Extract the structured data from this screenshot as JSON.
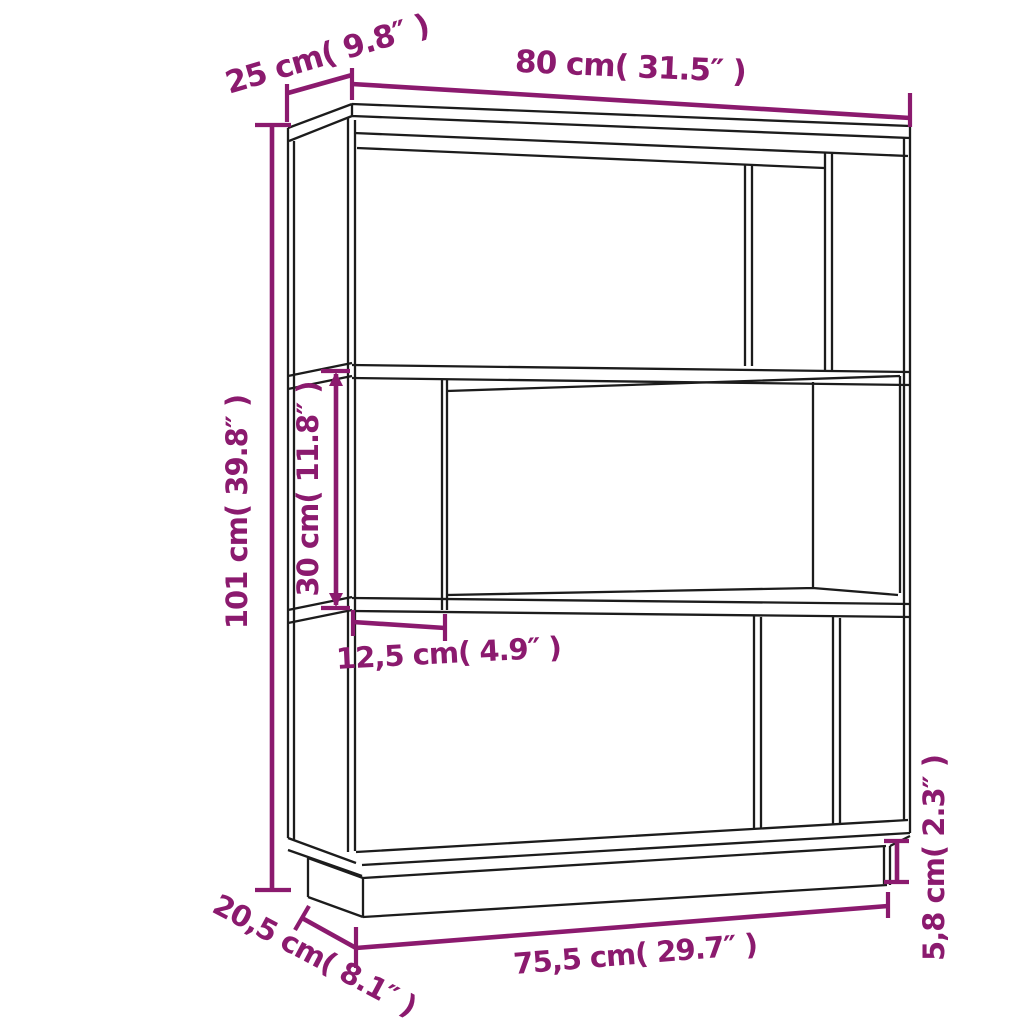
{
  "page": {
    "background": "#ffffff"
  },
  "diagram": {
    "title": "3-tier book cabinet / room divider dimension drawing",
    "style": {
      "dimension_color": "#8B1A6E",
      "outline_color": "#1c1c1c",
      "background": "#ffffff"
    },
    "labels": {
      "top_depth": "25 cm( 9.8″ )",
      "top_width": "80 cm( 31.5″ )",
      "total_height": "101 cm( 39.8″ )",
      "compartment_height": "30 cm( 11.8″ )",
      "divider_width": "12,5 cm( 4.9″ )",
      "base_width": "75,5 cm( 29.7″ )",
      "base_depth": "20,5 cm( 8.1″ )",
      "plinth_height": "5,8 cm( 2.3″ )"
    }
  }
}
